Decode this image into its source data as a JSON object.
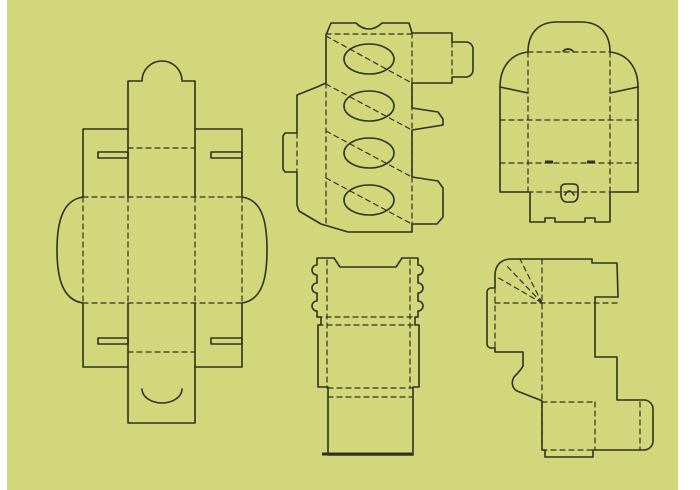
{
  "canvas": {
    "width": 700,
    "height": 490,
    "background_color": "#d3d77b",
    "line_color": "#2e331f",
    "margin_color": "#ffffff",
    "left_margin_width": 7,
    "right_margin_width": 22
  },
  "dielines": [
    {
      "id": "tall-tuck-box-dieline",
      "label": "tall tuck-top box template",
      "paths": [
        {
          "type": "cut",
          "d": "M128,81 L142,81 A20,20 0 0 1 182,81 L195,81 L195,129 L242,129 L242,197 C262,200 267,221 267,250 C267,279 262,300 242,303 L242,367 L195,367 L195,423 L128,423 L128,367 L83,367 L83,303 C63,300 57,279 57,250 C57,221 63,200 83,197 L83,129 L128,129 Z"
        },
        {
          "type": "cut",
          "d": "M128,129 L128,197 M195,129 L195,197 M128,303 L128,367 M195,303 L195,367"
        },
        {
          "type": "cut",
          "d": "M98,152 L128,152 L128,158 L98,158 Z M211,152 L242,152 L242,158 L211,158 Z"
        },
        {
          "type": "cut",
          "d": "M98,338 L128,338 L128,344 L98,344 Z M211,338 L242,338 L242,344 L211,344 Z"
        },
        {
          "type": "cut",
          "d": "M142,389 A20,14 0 0 0 182,389"
        },
        {
          "type": "fold",
          "d": "M128,148 L195,148 M128,352 L195,352"
        },
        {
          "type": "fold",
          "d": "M83,197 L242,197 M83,303 L242,303"
        },
        {
          "type": "fold",
          "d": "M83,197 L83,303 M128,197 L128,303 M195,197 L195,303 M242,197 L242,303"
        }
      ],
      "ellipses": []
    },
    {
      "id": "cupcake-wrap-dieline",
      "label": "wrap template with four ellipse cutouts",
      "paths": [
        {
          "type": "cut",
          "d": "M326,83 L326,35 L331,23 L356,23 Q362,29 369,29 Q376,29 382,23 L409,23 L412,33 L452,33 L452,42 L466,42 A7,7 0 0 1 473,49 L473,70 A7,7 0 0 1 466,77 L452,77 L452,83 L412,83 L412,108 L438,112 L443,119 L443,125 L412,130 L412,177 L438,181 L443,188 L443,217 L437,224 L412,224 L412,232 L348,232 L321,224 L299,211 L297,205 L297,172 L285,172 L283,169 L283,136 L285,133 L297,133 L297,95 L317,87 Z"
        },
        {
          "type": "fold",
          "d": "M326,34 L412,34"
        },
        {
          "type": "fold",
          "d": "M326,83 L326,224"
        },
        {
          "type": "fold",
          "d": "M412,33 L412,232"
        },
        {
          "type": "fold",
          "d": "M326,36 L410,82 M326,84 L410,129 M326,131 L410,176 M326,178 L410,223"
        },
        {
          "type": "fold",
          "d": "M452,42 L452,77"
        },
        {
          "type": "fold",
          "d": "M297,133 L297,172"
        }
      ],
      "ellipses": [
        {
          "cx": 369,
          "cy": 59,
          "rx": 25,
          "ry": 15
        },
        {
          "cx": 369,
          "cy": 106,
          "rx": 25,
          "ry": 15
        },
        {
          "cx": 369,
          "cy": 153,
          "rx": 25,
          "ry": 15
        },
        {
          "cx": 369,
          "cy": 200,
          "rx": 25,
          "ry": 15
        }
      ]
    },
    {
      "id": "dome-lid-box-dieline",
      "label": "dome-lid box template with push lock",
      "paths": [
        {
          "type": "cut",
          "d": "M528,52 C528,36 536,22 557,22 L581,22 C602,22 610,36 610,52"
        },
        {
          "type": "cut",
          "d": "M500,87 C500,68 510,54 528,52 M610,52 C628,54 638,68 638,87"
        },
        {
          "type": "cut",
          "d": "M500,87 L528,93 M638,87 L610,93"
        },
        {
          "type": "cut",
          "d": "M500,87 L500,192 L528,192 M638,87 L638,192 L610,192"
        },
        {
          "type": "cut",
          "d": "M530,193 L530,222 L545,222 L545,218 L555,218 L555,222 L585,222 L585,218 L595,218 L595,222 L610,222 L610,193"
        },
        {
          "type": "cut",
          "d": "M563,51 Q568,47 573,51"
        },
        {
          "type": "cut",
          "d": "M561,194 L561,188 Q561,184 566,184 L573,184 Q578,184 578,188 L578,194 Q578,201 573,202 L566,202 Q561,201 561,194 Z"
        },
        {
          "type": "cut",
          "d": "M565,195 Q569,187 574,195"
        },
        {
          "type": "slit",
          "d": "M545,162 L553,162 M587,162 L595,162"
        },
        {
          "type": "fold",
          "d": "M528,52 L610,52"
        },
        {
          "type": "fold",
          "d": "M528,52 L528,192 M610,52 L610,192"
        },
        {
          "type": "fold",
          "d": "M500,120 L638,120 M500,163 L638,163"
        },
        {
          "type": "fold",
          "d": "M528,192 L610,192"
        }
      ],
      "ellipses": []
    },
    {
      "id": "sleeve-box-dieline",
      "label": "sleeve box template with side bumps",
      "paths": [
        {
          "type": "cut",
          "d": "M317,258 L334,258 L340,267 L396,267 L402,258 L418,258 L418,265 A5,5 0 0 1 418,275 L418,283 A5,5 0 0 1 418,293 L418,301 A5,5 0 0 1 418,311 L418,317 L415,317 L415,325 L419,325 L419,387 L413,387 L413,455 L328,455 L328,387 L318,387 L318,325 L321,325 L321,317 L317,317 L317,311 A5,5 0 0 1 317,301 L317,293 A5,5 0 0 1 317,283 L317,275 A5,5 0 0 1 317,265 Z"
        },
        {
          "type": "slit",
          "d": "M322,454 L412,454"
        },
        {
          "type": "fold",
          "d": "M327,260 L327,388 M410,260 L410,388"
        },
        {
          "type": "fold",
          "d": "M317,317 L418,317 M318,325 L419,325"
        },
        {
          "type": "fold",
          "d": "M328,388 L413,388 M328,397 L413,397"
        }
      ],
      "ellipses": []
    },
    {
      "id": "wrap-box-dieline",
      "label": "wrap-around box template with fan folds",
      "paths": [
        {
          "type": "cut",
          "d": "M495,274 Q496,261 509,259 L592,259 L592,263 L617,263 L618,297 L595,297 L595,357 L617,357 L617,400 L644,400 A9,9 0 0 1 653,409 L653,441 A9,9 0 0 1 644,450 L595,450 L593,450 L593,457 L545,457 L545,450 L542,450 L542,401 L540,400 L517,391 C512,388 511,382 514,377 C518,373 521,370 523,366 L523,352 L495,352 L495,348 L491,348 A4,4 0 0 1 487,344 L487,292 A4,4 0 0 1 491,288 L495,288 Z"
        },
        {
          "type": "fold",
          "d": "M542,259 L542,450"
        },
        {
          "type": "fold",
          "d": "M495,303 L618,303"
        },
        {
          "type": "fold",
          "d": "M542,303 L497,277 M542,303 L505,264 M542,303 L520,259"
        },
        {
          "type": "fold",
          "d": "M495,288 L495,348"
        },
        {
          "type": "fold",
          "d": "M595,402 L595,450 M640,402 L640,450"
        },
        {
          "type": "fold",
          "d": "M542,402 L595,402 M542,450 L593,450"
        }
      ],
      "ellipses": []
    }
  ]
}
